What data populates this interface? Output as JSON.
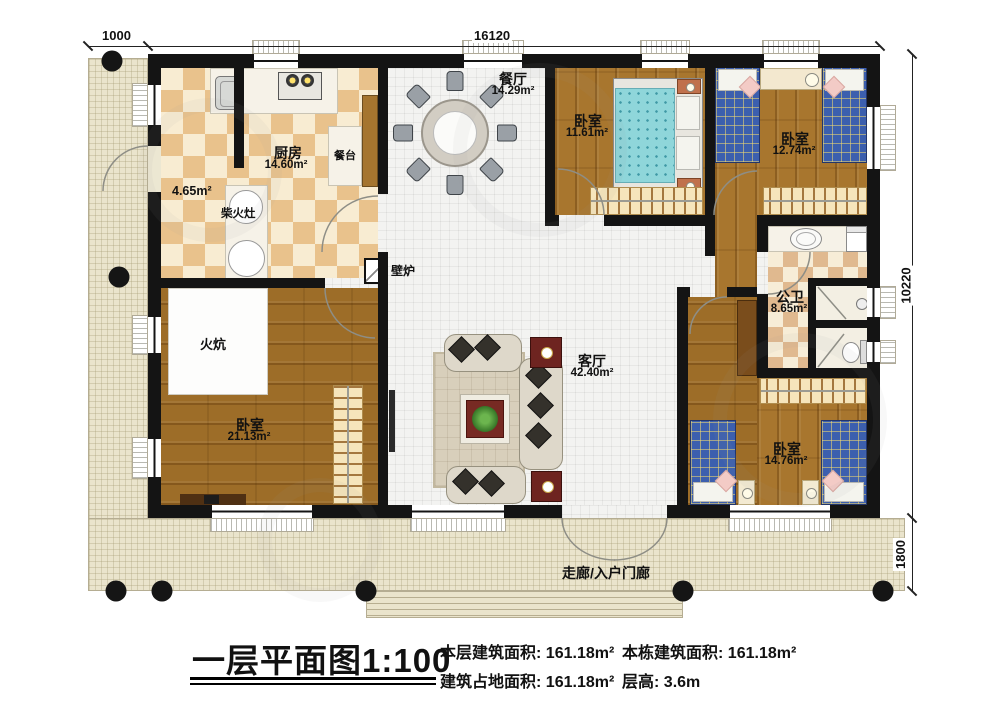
{
  "dimensions": {
    "left_width": "1000",
    "total_width": "16120",
    "total_depth": "10220",
    "porch_depth": "1800"
  },
  "rooms": {
    "kitchen": {
      "name": "厨房",
      "area": "14.60m²"
    },
    "pantry": {
      "area": "4.65m²"
    },
    "wood_stove": {
      "name": "柴火灶"
    },
    "counter": {
      "name": "餐台"
    },
    "dining": {
      "name": "餐厅",
      "area": "14.29m²"
    },
    "bedroom_top_mid": {
      "name": "卧室",
      "area": "11.61m²"
    },
    "bedroom_top_right": {
      "name": "卧室",
      "area": "12.74m²"
    },
    "bathroom": {
      "name": "公卫",
      "area": "8.65m²"
    },
    "living": {
      "name": "客厅",
      "area": "42.40m²"
    },
    "bedroom_left": {
      "name": "卧室",
      "area": "21.13m²"
    },
    "kang": {
      "name": "火炕"
    },
    "fireplace": {
      "name": "壁炉"
    },
    "bedroom_bottom_right": {
      "name": "卧室",
      "area": "14.76m²"
    },
    "porch": {
      "name": "走廊/入户门廊"
    }
  },
  "title": {
    "text": "一层平面图",
    "scale": "1:100"
  },
  "stats": {
    "items": [
      {
        "label": "本层建筑面积:",
        "value": "161.18m²"
      },
      {
        "label": "本栋建筑面积:",
        "value": "161.18m²"
      },
      {
        "label": "建筑占地面积:",
        "value": "161.18m²"
      },
      {
        "label": "层高:",
        "value": "3.6m"
      }
    ]
  }
}
